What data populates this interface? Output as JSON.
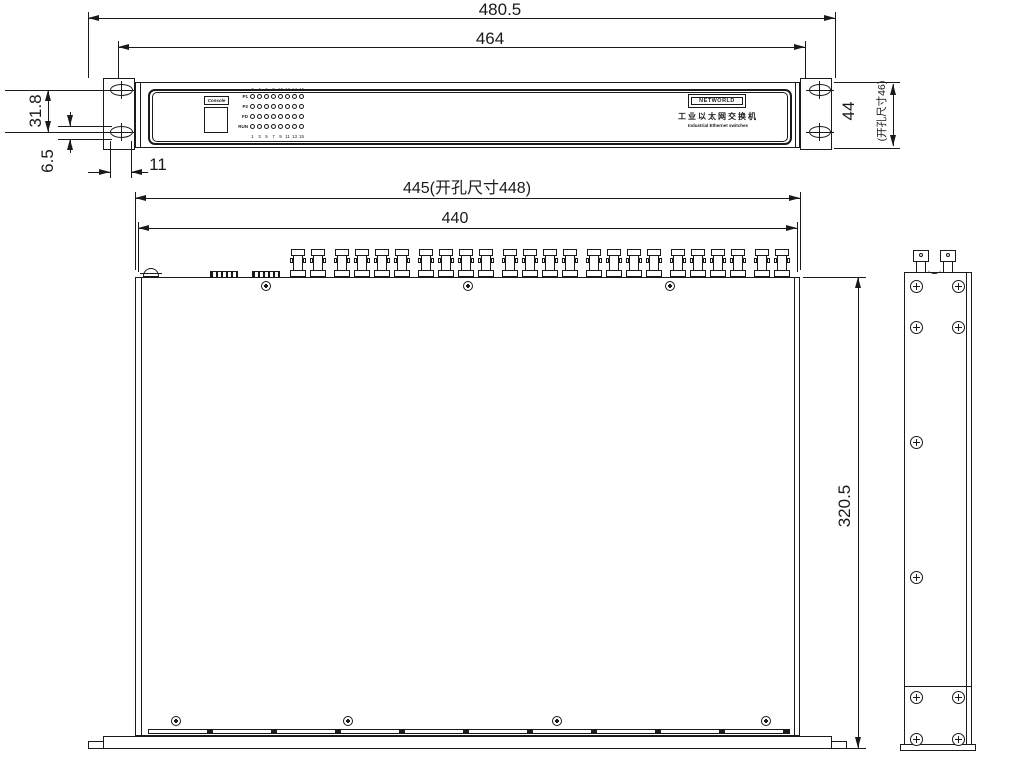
{
  "dims": {
    "front_overall_width": "480.5",
    "front_mount_width": "464",
    "ear_hole_pitch": "31.8",
    "ear_slot_height": "6.5",
    "ear_slot_width": "11",
    "front_height": "44",
    "front_height_cutout": "(开孔尺寸46)",
    "top_width_with_cutout": "445(开孔尺寸448)",
    "top_inner_width": "440",
    "top_depth": "320.5"
  },
  "front_panel": {
    "console_label": "Console",
    "led_row_labels": [
      "P1",
      "P2",
      "FD",
      "RUN"
    ],
    "led_col_top": [
      "2",
      "4",
      "6",
      "8",
      "10",
      "12",
      "14",
      "16"
    ],
    "led_col_bottom": [
      "1",
      "3",
      "5",
      "7",
      "9",
      "11",
      "13",
      "15"
    ],
    "brand_logo": "NETWORLD",
    "brand_product_cn": "工业以太网交换机",
    "brand_product_en": "Industrial Ethernet switches"
  },
  "top_view": {
    "fiber_connector_groups": [
      2,
      4,
      4,
      4,
      4,
      4,
      2
    ]
  },
  "colors": {
    "line": "#1a1a1a",
    "background": "#ffffff"
  }
}
